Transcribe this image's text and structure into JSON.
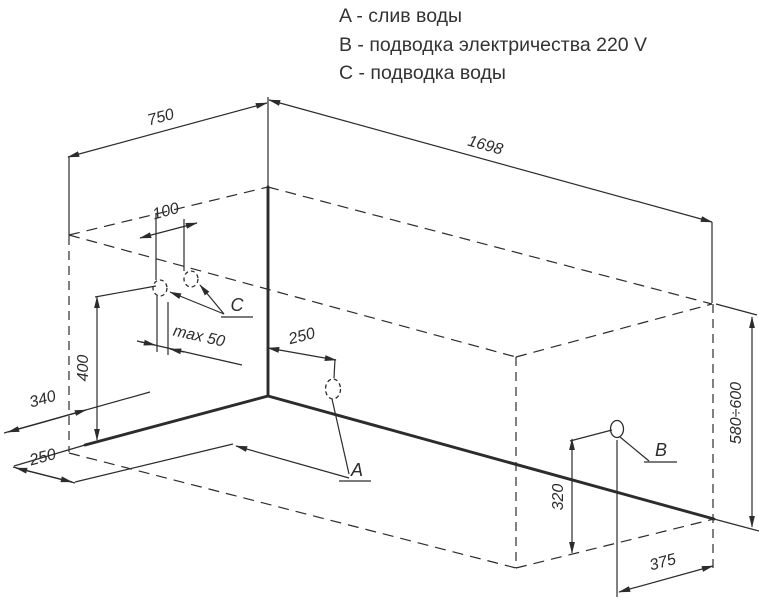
{
  "legend": {
    "items": [
      "A - слив воды",
      "B - подводка электричества 220 V",
      "C - подводка воды"
    ]
  },
  "labels": {
    "drain": "A",
    "electric": "B",
    "water": "C"
  },
  "dims": {
    "width_top": "750",
    "length_top": "1698",
    "water_spacing": "100",
    "water_offset_max": "max 50",
    "water_height": "400",
    "floor_side": "340",
    "floor_front": "250",
    "drain_offset": "250",
    "electric_height": "320",
    "electric_offset": "375",
    "rim_height": "580÷600"
  }
}
